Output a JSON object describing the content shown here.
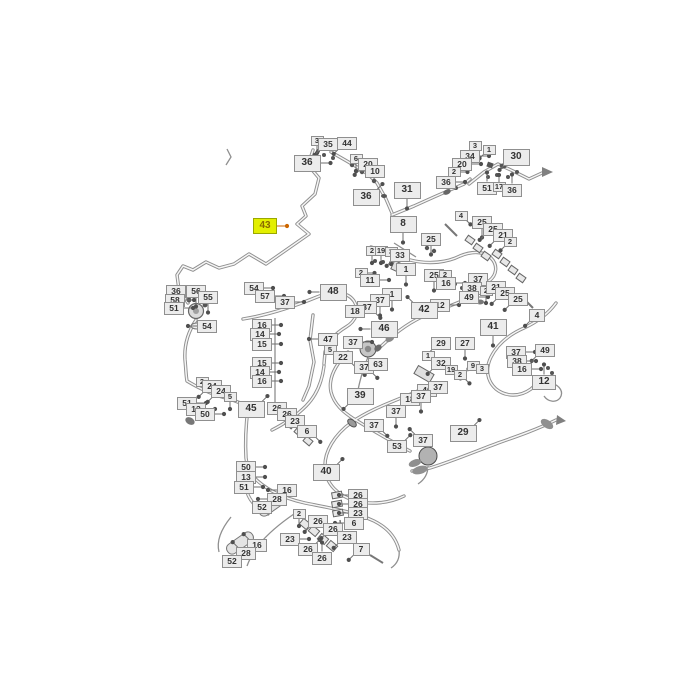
{
  "diagram": {
    "background_color": "#ffffff",
    "callout_fill": "#ececec",
    "callout_border": "#8f8f8f",
    "callout_text_color": "#333333",
    "highlight_fill": "#e3ef00",
    "highlight_text_color": "#8a6a00",
    "selected_callout": "43"
  },
  "labels": [
    {
      "t": "3",
      "x": 317,
      "y": 141,
      "s": "s",
      "d": "s"
    },
    {
      "t": "35",
      "x": 328,
      "y": 144,
      "s": "m",
      "d": "sw"
    },
    {
      "t": "44",
      "x": 347,
      "y": 143,
      "s": "m",
      "d": "sw"
    },
    {
      "t": "36",
      "x": 307,
      "y": 163,
      "s": "l",
      "d": "e"
    },
    {
      "t": "6",
      "x": 356,
      "y": 159,
      "s": "s",
      "d": "s"
    },
    {
      "t": "20",
      "x": 368,
      "y": 164,
      "s": "m",
      "d": "sw"
    },
    {
      "t": "10",
      "x": 375,
      "y": 171,
      "s": "m",
      "d": "w"
    },
    {
      "t": "36",
      "x": 366,
      "y": 197,
      "s": "l",
      "d": "ne"
    },
    {
      "t": "31",
      "x": 407,
      "y": 190,
      "s": "l",
      "d": "s"
    },
    {
      "t": "43",
      "x": 265,
      "y": 226,
      "s": "l",
      "d": "e",
      "hl": true,
      "w": 24,
      "h": 16
    },
    {
      "t": "8",
      "x": 403,
      "y": 224,
      "s": "l",
      "d": "s"
    },
    {
      "t": "25",
      "x": 431,
      "y": 239,
      "s": "m",
      "d": "s"
    },
    {
      "t": "3",
      "x": 475,
      "y": 146,
      "s": "s",
      "d": "s"
    },
    {
      "t": "1",
      "x": 489,
      "y": 150,
      "s": "s",
      "d": "sw"
    },
    {
      "t": "34",
      "x": 470,
      "y": 156,
      "s": "m",
      "d": "e"
    },
    {
      "t": "20",
      "x": 462,
      "y": 164,
      "s": "m",
      "d": "e"
    },
    {
      "t": "2",
      "x": 454,
      "y": 172,
      "s": "s",
      "d": "e"
    },
    {
      "t": "36",
      "x": 446,
      "y": 182,
      "s": "m",
      "d": "e"
    },
    {
      "t": "30",
      "x": 516,
      "y": 157,
      "s": "l",
      "d": "sw"
    },
    {
      "t": "51",
      "x": 487,
      "y": 188,
      "s": "m",
      "d": "n"
    },
    {
      "t": "17",
      "x": 499,
      "y": 187,
      "s": "s",
      "d": "n"
    },
    {
      "t": "36",
      "x": 512,
      "y": 190,
      "s": "m",
      "d": "n"
    },
    {
      "t": "2",
      "x": 372,
      "y": 251,
      "s": "s",
      "d": "s"
    },
    {
      "t": "19",
      "x": 381,
      "y": 251,
      "s": "s",
      "d": "s"
    },
    {
      "t": "3",
      "x": 391,
      "y": 252,
      "s": "s",
      "d": "s"
    },
    {
      "t": "33",
      "x": 400,
      "y": 255,
      "s": "m",
      "d": "sw"
    },
    {
      "t": "2",
      "x": 361,
      "y": 273,
      "s": "s",
      "d": "e"
    },
    {
      "t": "11",
      "x": 370,
      "y": 280,
      "s": "m",
      "d": "e"
    },
    {
      "t": "1",
      "x": 406,
      "y": 269,
      "s": "m",
      "d": "s"
    },
    {
      "t": "25",
      "x": 434,
      "y": 275,
      "s": "m",
      "d": "s"
    },
    {
      "t": "2",
      "x": 445,
      "y": 275,
      "s": "s",
      "d": "s"
    },
    {
      "t": "16",
      "x": 446,
      "y": 283,
      "s": "m",
      "d": "e"
    },
    {
      "t": "37",
      "x": 478,
      "y": 279,
      "s": "m",
      "d": "sw"
    },
    {
      "t": "38",
      "x": 472,
      "y": 288,
      "s": "m",
      "d": "e"
    },
    {
      "t": "2",
      "x": 486,
      "y": 291,
      "s": "s",
      "d": "s"
    },
    {
      "t": "21",
      "x": 496,
      "y": 287,
      "s": "m",
      "d": "w"
    },
    {
      "t": "49",
      "x": 469,
      "y": 297,
      "s": "m",
      "d": "e"
    },
    {
      "t": "25",
      "x": 505,
      "y": 293,
      "s": "m",
      "d": "sw"
    },
    {
      "t": "25",
      "x": 518,
      "y": 299,
      "s": "m",
      "d": "sw"
    },
    {
      "t": "12",
      "x": 440,
      "y": 305,
      "s": "m",
      "d": "e"
    },
    {
      "t": "42",
      "x": 424,
      "y": 310,
      "s": "l",
      "d": "nw"
    },
    {
      "t": "1",
      "x": 392,
      "y": 294,
      "s": "m",
      "d": "s"
    },
    {
      "t": "37",
      "x": 380,
      "y": 300,
      "s": "m",
      "d": "s"
    },
    {
      "t": "37",
      "x": 367,
      "y": 307,
      "s": "m",
      "d": "se"
    },
    {
      "t": "18",
      "x": 355,
      "y": 311,
      "s": "m",
      "d": "e"
    },
    {
      "t": "46",
      "x": 384,
      "y": 329,
      "s": "l",
      "d": "w"
    },
    {
      "t": "48",
      "x": 333,
      "y": 292,
      "s": "l",
      "d": "w"
    },
    {
      "t": "54",
      "x": 254,
      "y": 288,
      "s": "m",
      "d": "e"
    },
    {
      "t": "57",
      "x": 265,
      "y": 296,
      "s": "m",
      "d": "e"
    },
    {
      "t": "37",
      "x": 285,
      "y": 302,
      "s": "m",
      "d": "e"
    },
    {
      "t": "36",
      "x": 176,
      "y": 291,
      "s": "m",
      "d": "e"
    },
    {
      "t": "56",
      "x": 196,
      "y": 291,
      "s": "m",
      "d": "s"
    },
    {
      "t": "58",
      "x": 175,
      "y": 300,
      "s": "m",
      "d": "e"
    },
    {
      "t": "55",
      "x": 208,
      "y": 297,
      "s": "m",
      "d": "s"
    },
    {
      "t": "51",
      "x": 174,
      "y": 308,
      "s": "m",
      "d": "e"
    },
    {
      "t": "54",
      "x": 207,
      "y": 326,
      "s": "m",
      "d": "w"
    },
    {
      "t": "4",
      "x": 461,
      "y": 216,
      "s": "s",
      "d": "se"
    },
    {
      "t": "25",
      "x": 482,
      "y": 222,
      "s": "m",
      "d": "s"
    },
    {
      "t": "25",
      "x": 493,
      "y": 229,
      "s": "m",
      "d": "sw"
    },
    {
      "t": "21",
      "x": 503,
      "y": 235,
      "s": "m",
      "d": "sw"
    },
    {
      "t": "2",
      "x": 510,
      "y": 242,
      "s": "s",
      "d": "sw"
    },
    {
      "t": "16",
      "x": 262,
      "y": 325,
      "s": "m",
      "d": "e"
    },
    {
      "t": "14",
      "x": 260,
      "y": 334,
      "s": "m",
      "d": "e"
    },
    {
      "t": "15",
      "x": 262,
      "y": 344,
      "s": "m",
      "d": "e"
    },
    {
      "t": "15",
      "x": 262,
      "y": 363,
      "s": "m",
      "d": "e"
    },
    {
      "t": "14",
      "x": 260,
      "y": 372,
      "s": "m",
      "d": "e"
    },
    {
      "t": "16",
      "x": 262,
      "y": 381,
      "s": "m",
      "d": "e"
    },
    {
      "t": "47",
      "x": 328,
      "y": 339,
      "s": "m",
      "d": "w"
    },
    {
      "t": "5",
      "x": 330,
      "y": 350,
      "s": "s",
      "d": "se"
    },
    {
      "t": "22",
      "x": 343,
      "y": 357,
      "s": "m",
      "d": "se"
    },
    {
      "t": "37",
      "x": 353,
      "y": 342,
      "s": "m",
      "d": "e"
    },
    {
      "t": "37",
      "x": 364,
      "y": 367,
      "s": "m",
      "d": "se"
    },
    {
      "t": "63",
      "x": 378,
      "y": 364,
      "s": "m",
      "d": "sw"
    },
    {
      "t": "2",
      "x": 202,
      "y": 382,
      "s": "s",
      "d": "se"
    },
    {
      "t": "24",
      "x": 212,
      "y": 386,
      "s": "m",
      "d": "sw"
    },
    {
      "t": "24",
      "x": 221,
      "y": 391,
      "s": "m",
      "d": "sw"
    },
    {
      "t": "51",
      "x": 187,
      "y": 403,
      "s": "m",
      "d": "e"
    },
    {
      "t": "13",
      "x": 196,
      "y": 409,
      "s": "m",
      "d": "e"
    },
    {
      "t": "50",
      "x": 205,
      "y": 414,
      "s": "m",
      "d": "e"
    },
    {
      "t": "5",
      "x": 230,
      "y": 397,
      "s": "s",
      "d": "s"
    },
    {
      "t": "45",
      "x": 251,
      "y": 409,
      "s": "l",
      "d": "ne"
    },
    {
      "t": "26",
      "x": 277,
      "y": 408,
      "s": "m",
      "d": "se"
    },
    {
      "t": "26",
      "x": 287,
      "y": 414,
      "s": "m",
      "d": "se"
    },
    {
      "t": "23",
      "x": 295,
      "y": 421,
      "s": "m",
      "d": "se"
    },
    {
      "t": "6",
      "x": 307,
      "y": 431,
      "s": "m",
      "d": "se"
    },
    {
      "t": "39",
      "x": 360,
      "y": 396,
      "s": "l",
      "d": "sw"
    },
    {
      "t": "50",
      "x": 246,
      "y": 467,
      "s": "m",
      "d": "e"
    },
    {
      "t": "13",
      "x": 246,
      "y": 477,
      "s": "m",
      "d": "e"
    },
    {
      "t": "51",
      "x": 244,
      "y": 487,
      "s": "m",
      "d": "e"
    },
    {
      "t": "16",
      "x": 287,
      "y": 490,
      "s": "m",
      "d": "w"
    },
    {
      "t": "28",
      "x": 277,
      "y": 499,
      "s": "m",
      "d": "w"
    },
    {
      "t": "52",
      "x": 262,
      "y": 507,
      "s": "m",
      "d": "ne"
    },
    {
      "t": "40",
      "x": 326,
      "y": 472,
      "s": "l",
      "d": "ne"
    },
    {
      "t": "16",
      "x": 257,
      "y": 545,
      "s": "m",
      "d": "nw"
    },
    {
      "t": "28",
      "x": 246,
      "y": 553,
      "s": "m",
      "d": "nw"
    },
    {
      "t": "52",
      "x": 232,
      "y": 561,
      "s": "m",
      "d": "ne"
    },
    {
      "t": "2",
      "x": 299,
      "y": 514,
      "s": "s",
      "d": "s"
    },
    {
      "t": "26",
      "x": 318,
      "y": 521,
      "s": "m",
      "d": "sw"
    },
    {
      "t": "26",
      "x": 333,
      "y": 529,
      "s": "m",
      "d": "sw"
    },
    {
      "t": "23",
      "x": 290,
      "y": 539,
      "s": "m",
      "d": "e"
    },
    {
      "t": "23",
      "x": 347,
      "y": 537,
      "s": "m",
      "d": "sw"
    },
    {
      "t": "26",
      "x": 308,
      "y": 549,
      "s": "m",
      "d": "ne"
    },
    {
      "t": "26",
      "x": 322,
      "y": 558,
      "s": "m",
      "d": "n"
    },
    {
      "t": "7",
      "x": 361,
      "y": 549,
      "s": "m",
      "d": "sw",
      "w": 17,
      "h": 13
    },
    {
      "t": "26",
      "x": 358,
      "y": 495,
      "s": "m",
      "d": "w"
    },
    {
      "t": "26",
      "x": 358,
      "y": 504,
      "s": "m",
      "d": "w"
    },
    {
      "t": "23",
      "x": 358,
      "y": 513,
      "s": "m",
      "d": "w"
    },
    {
      "t": "6",
      "x": 354,
      "y": 523,
      "s": "m",
      "d": "w"
    },
    {
      "t": "29",
      "x": 441,
      "y": 343,
      "s": "m",
      "d": "sw"
    },
    {
      "t": "27",
      "x": 465,
      "y": 343,
      "s": "m",
      "d": "s"
    },
    {
      "t": "1",
      "x": 428,
      "y": 356,
      "s": "s",
      "d": "se"
    },
    {
      "t": "32",
      "x": 441,
      "y": 363,
      "s": "m",
      "d": "sw"
    },
    {
      "t": "19",
      "x": 451,
      "y": 370,
      "s": "s",
      "d": "se"
    },
    {
      "t": "2",
      "x": 460,
      "y": 375,
      "s": "s",
      "d": "se"
    },
    {
      "t": "9",
      "x": 473,
      "y": 366,
      "s": "s",
      "d": "sw"
    },
    {
      "t": "3",
      "x": 482,
      "y": 369,
      "s": "s",
      "d": "w"
    },
    {
      "t": "41",
      "x": 493,
      "y": 327,
      "s": "l",
      "d": "s"
    },
    {
      "t": "4",
      "x": 537,
      "y": 315,
      "s": "m",
      "d": "sw",
      "w": 16,
      "h": 13
    },
    {
      "t": "37",
      "x": 516,
      "y": 352,
      "s": "m",
      "d": "e"
    },
    {
      "t": "49",
      "x": 545,
      "y": 350,
      "s": "m",
      "d": "sw"
    },
    {
      "t": "38",
      "x": 517,
      "y": 361,
      "s": "m",
      "d": "e"
    },
    {
      "t": "16",
      "x": 522,
      "y": 369,
      "s": "m",
      "d": "e"
    },
    {
      "t": "12",
      "x": 544,
      "y": 382,
      "s": "l",
      "d": "n",
      "w": 24,
      "h": 15
    },
    {
      "t": "46",
      "x": 427,
      "y": 390,
      "s": "m",
      "d": "sw"
    },
    {
      "t": "37",
      "x": 438,
      "y": 387,
      "s": "m",
      "d": "sw"
    },
    {
      "t": "18",
      "x": 410,
      "y": 399,
      "s": "m",
      "d": "e"
    },
    {
      "t": "37",
      "x": 421,
      "y": 396,
      "s": "m",
      "d": "s"
    },
    {
      "t": "29",
      "x": 463,
      "y": 433,
      "s": "l",
      "d": "ne"
    },
    {
      "t": "37",
      "x": 423,
      "y": 440,
      "s": "m",
      "d": "nw"
    },
    {
      "t": "53",
      "x": 397,
      "y": 446,
      "s": "m",
      "d": "ne"
    },
    {
      "t": "37",
      "x": 374,
      "y": 425,
      "s": "m",
      "d": "se"
    },
    {
      "t": "37",
      "x": 396,
      "y": 411,
      "s": "m",
      "d": "s"
    }
  ]
}
